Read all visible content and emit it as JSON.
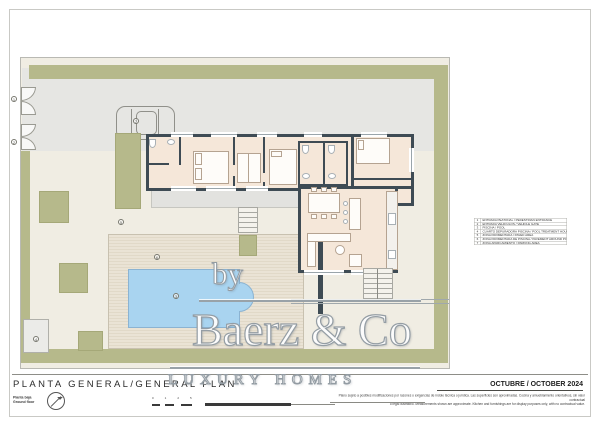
{
  "title_block": {
    "title": "PLANTA GENERAL/GENERAL PLAN",
    "floor_es": "Planta baja",
    "floor_en": "Ground floor",
    "date": "OCTUBRE / OCTOBER 2024",
    "disclaimer_line1": "Plano sujeto a posibles modificaciones por razones o exigencias de índole técnica o jurídica. Las superficies son aproximadas. Cocina y amueblamiento orientativos, sin valor contractual",
    "disclaimer_line2": "o legal ilustrativo. Measurements shown are approximate. Kitchen and furnishings are for display purposes only, with no contractual value."
  },
  "watermark": {
    "by": "by",
    "brand": "Baerz & Co",
    "tagline": "LUXURY HOMES"
  },
  "legend": {
    "rows": [
      {
        "num": "1",
        "label": "ENTRADA PEATONAL / PEDESTRIAN ENTRANCE"
      },
      {
        "num": "2",
        "label": "ENTRADA VEHICULOS / VEHICLE GATE"
      },
      {
        "num": "3",
        "label": "PISCINA / POOL"
      },
      {
        "num": "4",
        "label": "CUARTO DEPURADORA PISCINA / POOL TREATMENT HOUSE"
      },
      {
        "num": "5",
        "label": "ZONA PAVIMENTADA / PAVED AREA"
      },
      {
        "num": "6",
        "label": "ZONA PAVIMENTADA DE PISCINA / PAVEMENT AROUND POOL"
      },
      {
        "num": "7",
        "label": "ZONA APARCAMIENTO / PARKING AREA"
      }
    ]
  },
  "plan": {
    "callouts": [
      "1",
      "2",
      "3",
      "4",
      "5",
      "6",
      "7"
    ],
    "scale_ticks": [
      "0",
      "1",
      "2",
      "5"
    ]
  },
  "colors": {
    "olive_green": "#b6b98b",
    "pool_blue": "#a9d4f0",
    "wall_dark": "#3e4b54",
    "floor_cream": "#f5e7d9",
    "paving_gray": "#e6e6e3",
    "garden_beige": "#f0ede3",
    "deck_tan": "#eae3d5",
    "watermark_gray": "#939ca3"
  }
}
